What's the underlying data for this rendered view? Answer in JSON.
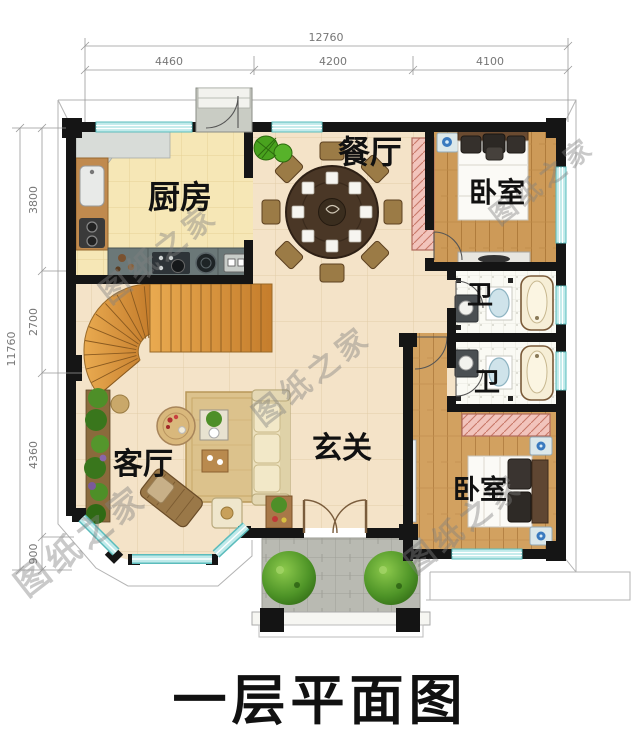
{
  "title": "一层平面图",
  "watermark": "图纸之家",
  "dimensions": {
    "top_total": "12760",
    "top_segments": [
      "4460",
      "4200",
      "4100"
    ],
    "left_total": "11760",
    "left_segments": [
      "3800",
      "2700",
      "4360",
      "900"
    ]
  },
  "rooms": {
    "kitchen": "厨房",
    "dining": "餐厅",
    "bedroom_top": "卧室",
    "bath_top": "卫",
    "bath_bottom": "卫",
    "living": "客厅",
    "foyer": "玄关",
    "bedroom_bottom": "卧室"
  },
  "colors": {
    "wall": "#151515",
    "window": "#bfeaea",
    "wood_floor": "#cd9a58",
    "tile_floor": "#f4e3c8",
    "kitchen_floor": "#f6e7b6",
    "stair": "#dd9a42",
    "porch_stone": "#b9bab2",
    "title_text": "#111111",
    "dimension_text": "#777777",
    "watermark_text": "#808080"
  }
}
